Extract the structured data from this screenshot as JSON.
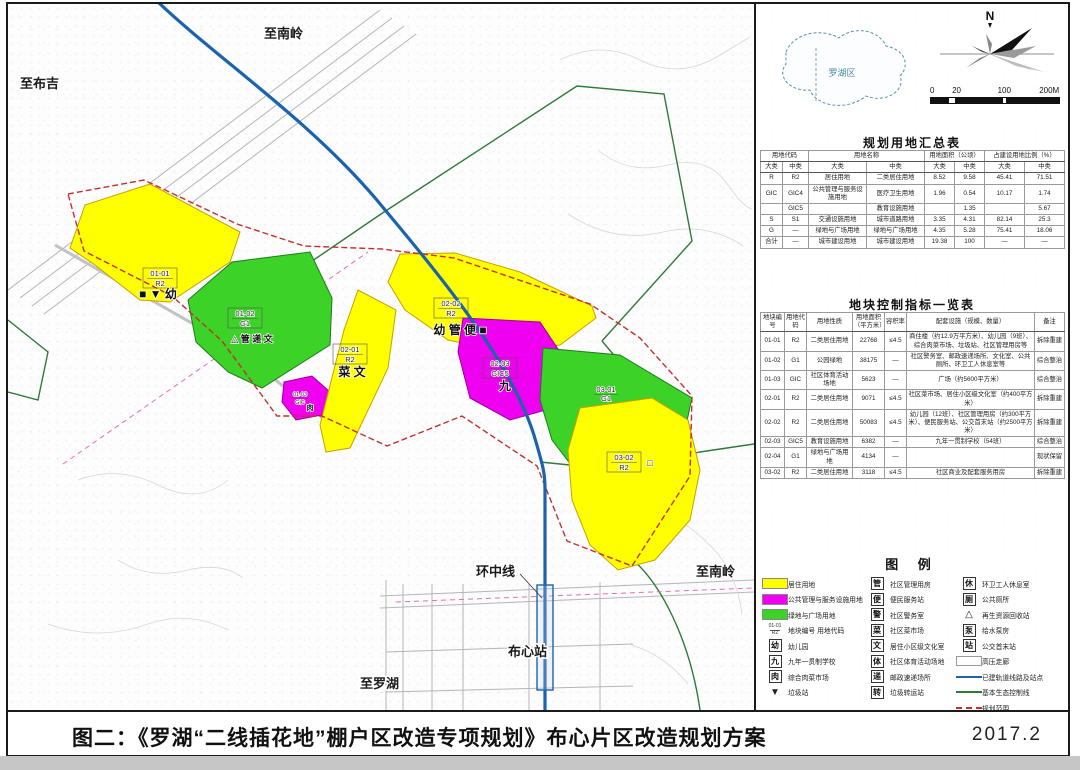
{
  "frame": {
    "figure_label": "图二：《罗湖“二线插花地”棚户区改造专项规划》布心片区改造规划方案",
    "date": "2017.2"
  },
  "compass": {
    "north_label": "N"
  },
  "scalebar": {
    "ticks": [
      "0",
      "20",
      "100",
      "200M"
    ]
  },
  "inset": {
    "district_label": "罗湖区"
  },
  "map_labels": {
    "to_nanling_top": "至南岭",
    "to_buji": "至布吉",
    "huanzhong_line": "环中线",
    "buxin_station": "布心站",
    "to_luohu": "至罗湖",
    "to_nanling_right": "至南岭"
  },
  "parcels": [
    {
      "no": "01-01",
      "code": "R2",
      "icons": "■ ▼ 幼"
    },
    {
      "no": "01-02",
      "code": "G1",
      "icons": "△ 管 递 文"
    },
    {
      "no": "01-03",
      "code": "GIC",
      "icons": "肉"
    },
    {
      "no": "02-01",
      "code": "R2",
      "icons": "菜 文"
    },
    {
      "no": "02-02",
      "code": "R2",
      "icons": "幼 管 便 ■"
    },
    {
      "no": "02-03",
      "code": "GIC5",
      "icons": "九"
    },
    {
      "no": "03-01",
      "code": "G1",
      "icons": ""
    },
    {
      "no": "03-02",
      "code": "R2",
      "icons": "□"
    }
  ],
  "colors": {
    "residential": "#ffff00",
    "public_facility": "#f000f0",
    "green_space": "#3cd228",
    "metro": "#1c63ae",
    "boundary": "#c23030",
    "eco_line": "#2d7a3a"
  },
  "summary_table": {
    "title": "规划用地汇总表",
    "groups": [
      "用地代码",
      "用地名称",
      "用地面积（公顷）",
      "占建设用地比例（%）"
    ],
    "subheaders": [
      "大类",
      "中类",
      "大类",
      "中类",
      "大类",
      "中类",
      "大类",
      "中类"
    ],
    "rows": [
      [
        "R",
        "R2",
        "居住用地",
        "二类居住用地",
        "8.52",
        "9.58",
        "45.41",
        "71.51"
      ],
      [
        "GIC",
        "GIC4",
        "公共管理与服务设施用地",
        "医疗卫生用地",
        "1.96",
        "0.54",
        "10.17",
        "1.74"
      ],
      [
        "",
        "GIC5",
        "",
        "教育设施用地",
        "",
        "1.35",
        "",
        "5.67"
      ],
      [
        "S",
        "S1",
        "交通设施用地",
        "城市道路用地",
        "3.35",
        "4.31",
        "82.14",
        "25.3"
      ],
      [
        "G",
        "—",
        "绿地与广场用地",
        "绿地与广场用地",
        "4.35",
        "5.28",
        "75.41",
        "18.06"
      ],
      [
        "合计",
        "—",
        "城市建设用地",
        "城市建设用地",
        "19.38",
        "100",
        "—",
        "—"
      ]
    ]
  },
  "indicator_table": {
    "title": "地块控制指标一览表",
    "headers": [
      "地块编号",
      "用地代码",
      "用地性质",
      "用地面积（平方米）",
      "容积率",
      "配套设施（规模、数量）",
      "备注"
    ],
    "rows": [
      [
        "01-01",
        "R2",
        "二类居住用地",
        "22768",
        "≤4.5",
        "商住楼（约12.9万平方米）、幼儿园（9班）、综合肉菜市场、垃圾站、社区管理用房等",
        "拆除重建"
      ],
      [
        "01-02",
        "G1",
        "公园绿地",
        "38175",
        "—",
        "社区警务室、邮政速递场所、文化室、公共厕所、环卫工人休息室等",
        "综合整治"
      ],
      [
        "01-03",
        "GIC",
        "社区体育活动场地",
        "5623",
        "—",
        "广场（约5600平方米）",
        "综合整治"
      ],
      [
        "02-01",
        "R2",
        "二类居住用地",
        "9071",
        "≤4.5",
        "社区菜市场、居住小区级文化室（约400平方米）",
        "拆除重建"
      ],
      [
        "02-02",
        "R2",
        "二类居住用地",
        "50083",
        "≤4.5",
        "幼儿园（12班）、社区管理用房（约300平方米）、便民服务站、公交首末站（约2500平方米）",
        "拆除重建"
      ],
      [
        "02-03",
        "GIC5",
        "教育设施用地",
        "6382",
        "—",
        "九年一贯制学校（54班）",
        "综合整治"
      ],
      [
        "02-04",
        "G1",
        "绿地与广场用地",
        "4134",
        "—",
        "",
        "现状保留"
      ],
      [
        "03-02",
        "R2",
        "二类居住用地",
        "3118",
        "≤4.5",
        "社区商业及配套服务用房",
        "拆除重建"
      ]
    ]
  },
  "legend": {
    "title": "图  例",
    "columns": [
      [
        {
          "type": "swatch",
          "name": "residential-swatch",
          "color": "#ffff00",
          "label": "居住用地"
        },
        {
          "type": "swatch",
          "name": "public-facility-swatch",
          "color": "#f000f0",
          "label": "公共管理与服务设施用地"
        },
        {
          "type": "swatch",
          "name": "green-space-swatch",
          "color": "#3cd228",
          "label": "绿地与广场用地"
        },
        {
          "type": "code",
          "name": "plot-code-icon",
          "top": "01-01",
          "bottom": "R2",
          "label": "地块编号 用地代码"
        },
        {
          "type": "box",
          "name": "kindergarten-icon",
          "char": "幼",
          "label": "幼儿园"
        },
        {
          "type": "box",
          "name": "nine-year-school-icon",
          "char": "九",
          "label": "九年一贯制学校"
        },
        {
          "type": "box",
          "name": "meat-market-icon",
          "char": "肉",
          "label": "综合肉菜市场"
        },
        {
          "type": "tri",
          "name": "garbage-station-icon",
          "char": "▼",
          "label": "垃圾站"
        }
      ],
      [
        {
          "type": "box",
          "name": "community-mgmt-icon",
          "char": "管",
          "label": "社区管理用房"
        },
        {
          "type": "box",
          "name": "convenience-service-icon",
          "char": "便",
          "label": "便民服务站"
        },
        {
          "type": "box",
          "name": "police-room-icon",
          "char": "警",
          "label": "社区警务室"
        },
        {
          "type": "box",
          "name": "market-icon",
          "char": "菜",
          "label": "社区菜市场"
        },
        {
          "type": "box",
          "name": "culture-room-icon",
          "char": "文",
          "label": "居住小区级文化室"
        },
        {
          "type": "box",
          "name": "sports-ground-icon",
          "char": "体",
          "label": "社区体育活动场地"
        },
        {
          "type": "box",
          "name": "post-express-icon",
          "char": "递",
          "label": "邮政速递场所"
        },
        {
          "type": "box",
          "name": "garbage-transfer-icon",
          "char": "转",
          "label": "垃圾转运站"
        }
      ],
      [
        {
          "type": "box",
          "name": "sanitation-rest-icon",
          "char": "休",
          "label": "环卫工人休息室"
        },
        {
          "type": "box",
          "name": "public-toilet-icon",
          "char": "厕",
          "label": "公共厕所"
        },
        {
          "type": "tri",
          "name": "recycling-icon",
          "char": "△",
          "label": "再生资源回收站"
        },
        {
          "type": "box",
          "name": "water-pump-icon",
          "char": "泵",
          "label": "给水泵房"
        },
        {
          "type": "box",
          "name": "bus-terminal-icon",
          "char": "站",
          "label": "公交首末站"
        },
        {
          "type": "band",
          "name": "hv-corridor-swatch",
          "label": "高压走廊"
        },
        {
          "type": "line",
          "name": "metro-line-sample",
          "color": "#1c63ae",
          "dash": "solid",
          "label": "已建轨道线路及站点"
        },
        {
          "type": "line",
          "name": "eco-line-sample",
          "color": "#2d7a3a",
          "dash": "solid",
          "label": "基本生态控制线"
        },
        {
          "type": "line",
          "name": "plan-boundary-sample",
          "color": "#c23030",
          "dash": "dashed",
          "label": "规划范围"
        }
      ]
    ]
  }
}
